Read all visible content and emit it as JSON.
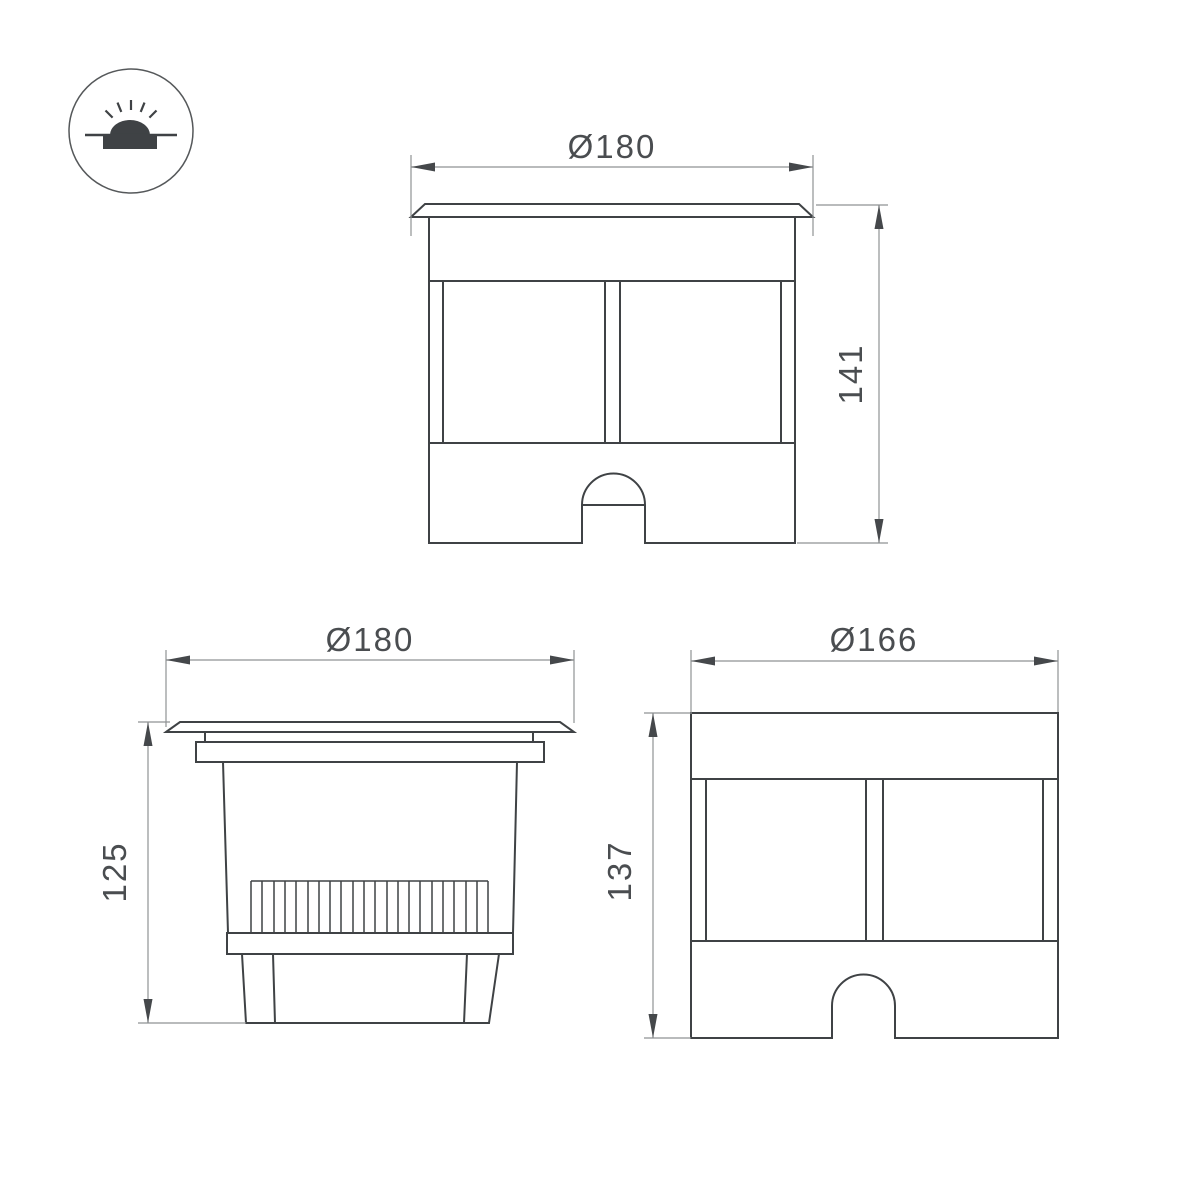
{
  "page": {
    "background": "#ffffff"
  },
  "colors": {
    "outline": "#3f4245",
    "dimension_lines": "#8f9294",
    "label_text": "#4a4d50"
  },
  "icon": {
    "name": "recessed-ground-light-icon"
  },
  "drawings": [
    {
      "view": "front-view-with-flange",
      "diameter_label": "Ø180",
      "height_label": "141"
    },
    {
      "view": "side-view-heatsink",
      "diameter_label": "Ø180",
      "height_label": "125"
    },
    {
      "view": "body-front-view",
      "diameter_label": "Ø166",
      "height_label": "137"
    }
  ]
}
